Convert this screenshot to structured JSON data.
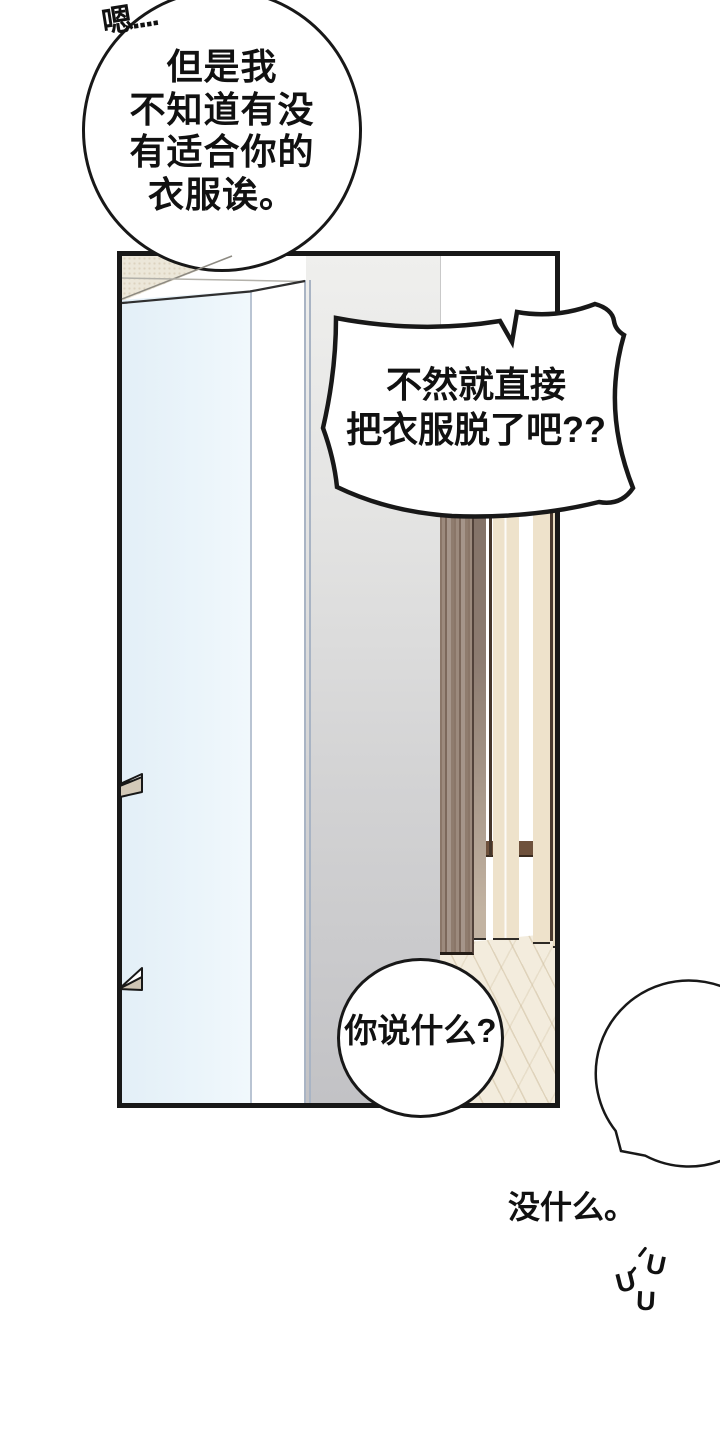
{
  "meta": {
    "type": "comic-page",
    "language": "zh",
    "description": "webtoon panel of an open wardrobe door with speech bubbles"
  },
  "colors": {
    "ink": "#181818",
    "paper": "#ffffff",
    "door_glass": "#eaf4fa",
    "wall_beige": "#ece7d9",
    "wall_gray": "#c2c2c5",
    "wood_dark": "#8d7a6c",
    "wood_slat_cream": "#eee2cb",
    "rail_brown": "#6e513c",
    "floor": "#f3ecdd",
    "bracket_tan": "#d3c9b8"
  },
  "sfx": {
    "hmm": "嗯...."
  },
  "bubbles": {
    "thought": {
      "shape": "ellipse",
      "lines": [
        "但是我",
        "不知道有没",
        "有适合你的",
        "衣服诶。"
      ]
    },
    "burst": {
      "shape": "burst",
      "lines": [
        "不然就直接",
        "把衣服脱了吧??"
      ]
    },
    "question": {
      "shape": "circle",
      "text": "你说什么?"
    },
    "reply": {
      "shape": "circle-notched",
      "text": "没什么。",
      "mumble": [
        "U",
        "U",
        "U"
      ]
    }
  }
}
